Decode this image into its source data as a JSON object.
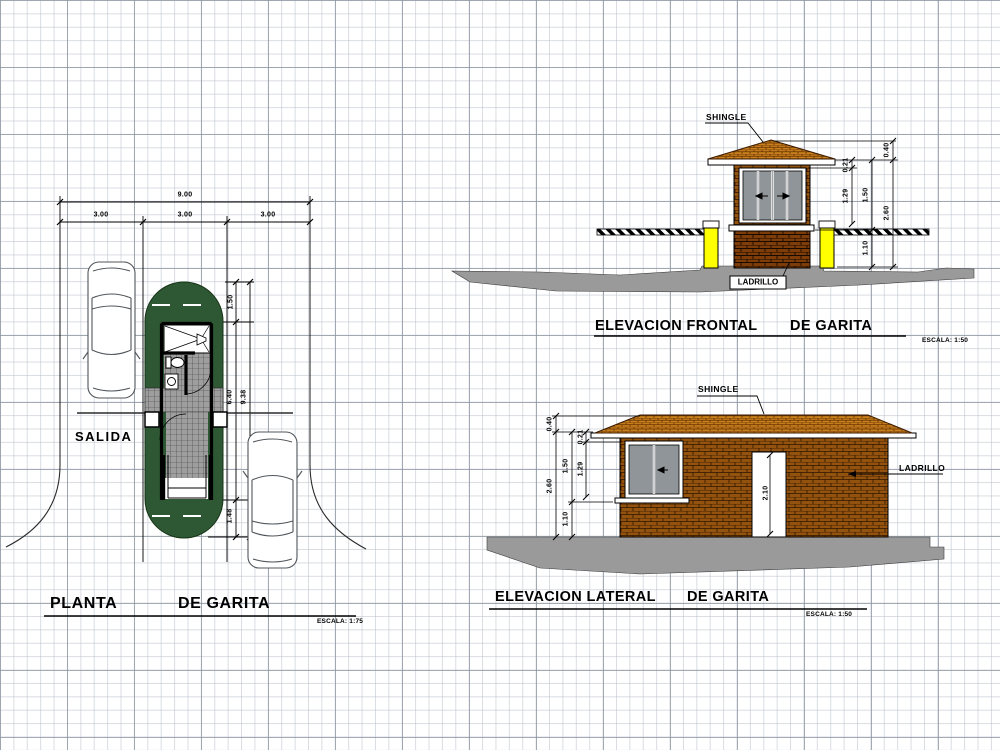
{
  "plan": {
    "title": {
      "left": "PLANTA",
      "right": "DE GARITA"
    },
    "scale": "ESCALA: 1:75",
    "salida_label": "SALIDA",
    "dims": {
      "total": "9.00",
      "lanes": [
        "3.00",
        "3.00",
        "3.00"
      ],
      "island_top": "1.50",
      "building_length": "6.40",
      "island_length": "9.38",
      "island_bottom": "1.48"
    }
  },
  "front_elevation": {
    "title": {
      "left": "ELEVACION FRONTAL",
      "right": "DE GARITA"
    },
    "scale": "ESCALA: 1:50",
    "shingle_label": "SHINGLE",
    "ladrillo_label": "LADRILLO",
    "dims": {
      "roof_height": "0.40",
      "eave_band": "0.21",
      "window_height": "1.29",
      "opening_height": "1.50",
      "wall_height": "1.10",
      "total_height": "2.60"
    }
  },
  "lateral_elevation": {
    "title": {
      "left": "ELEVACION LATERAL",
      "right": "DE GARITA"
    },
    "scale": "ESCALA: 1:50",
    "shingle_label": "SHINGLE",
    "ladrillo_label": "LADRILLO",
    "dims": {
      "roof_height": "0.40",
      "eave_band": "0.21",
      "window_height": "1.29",
      "opening_height": "1.50",
      "wall_height": "1.10",
      "total_height": "2.60",
      "door_height": "2.10"
    }
  },
  "colors": {
    "island_green": "#2e5733",
    "brick": "#94520f",
    "brick_dark": "#7e3c08",
    "shingle": "#c9801d",
    "post_yellow": "#ffff00",
    "ground_gray": "#9a9a9a",
    "tile_gray": "#9e9e9e"
  }
}
